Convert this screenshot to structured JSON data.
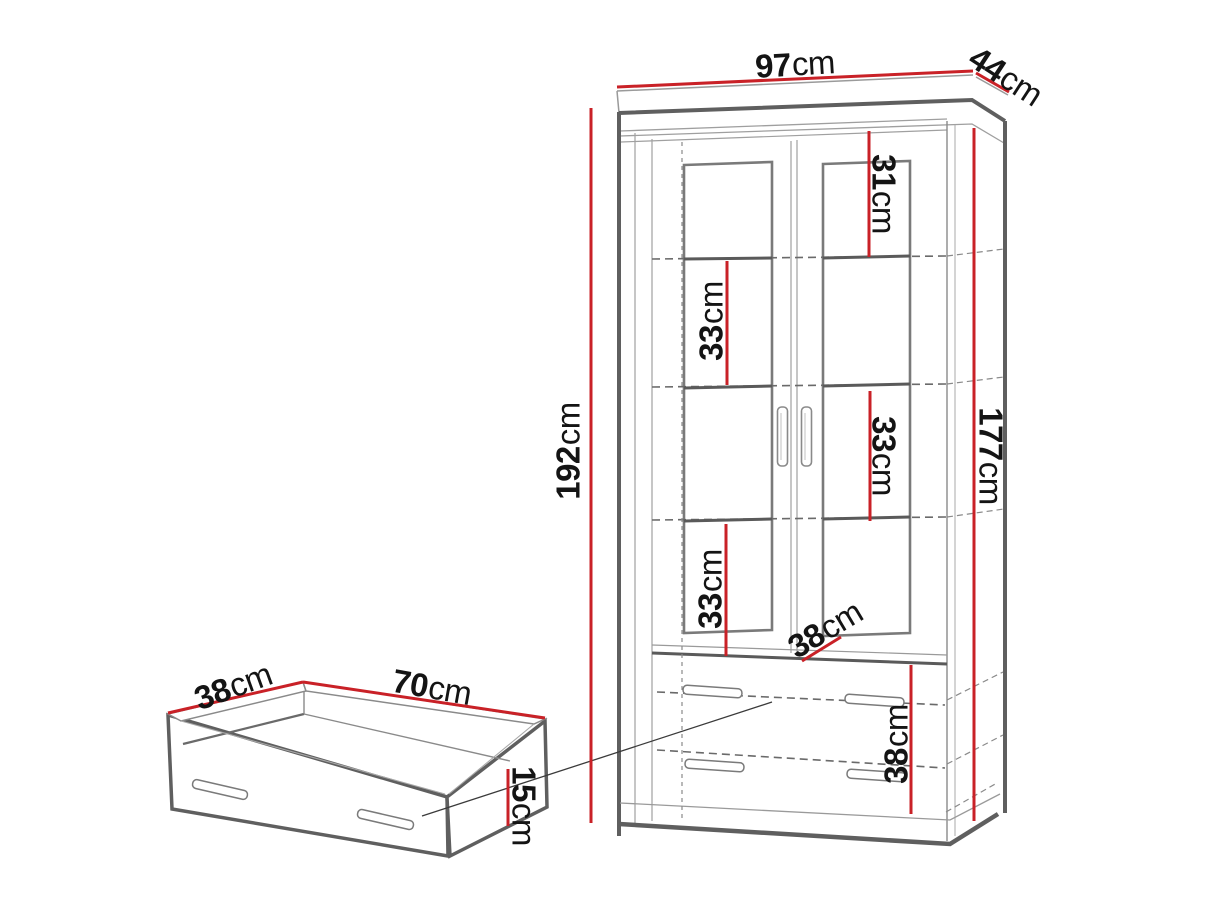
{
  "diagram_title": "Furniture dimension drawing: two-door display cabinet with drawers and pull-out drawer box",
  "colors": {
    "dimension_red": "#c92127",
    "outline_dark": "#5f5f5f",
    "outline_mid": "#7a7a7a",
    "dashed_gray": "#6a6a6a",
    "text": "#141414",
    "background": "#ffffff"
  },
  "dimensions": {
    "cabinet_width": {
      "value": "97",
      "unit": "cm"
    },
    "cabinet_depth": {
      "value": "44",
      "unit": "cm"
    },
    "cabinet_height": {
      "value": "192",
      "unit": "cm"
    },
    "interior_height": {
      "value": "177",
      "unit": "cm"
    },
    "top_compartment": {
      "value": "31",
      "unit": "cm"
    },
    "compartment_2": {
      "value": "33",
      "unit": "cm"
    },
    "compartment_3": {
      "value": "33",
      "unit": "cm"
    },
    "compartment_4": {
      "value": "33",
      "unit": "cm"
    },
    "interior_depth": {
      "value": "38",
      "unit": "cm"
    },
    "drawer_compartment": {
      "value": "38",
      "unit": "cm"
    },
    "drawer_depth": {
      "value": "38",
      "unit": "cm"
    },
    "drawer_width": {
      "value": "70",
      "unit": "cm"
    },
    "drawer_height": {
      "value": "15",
      "unit": "cm"
    }
  }
}
